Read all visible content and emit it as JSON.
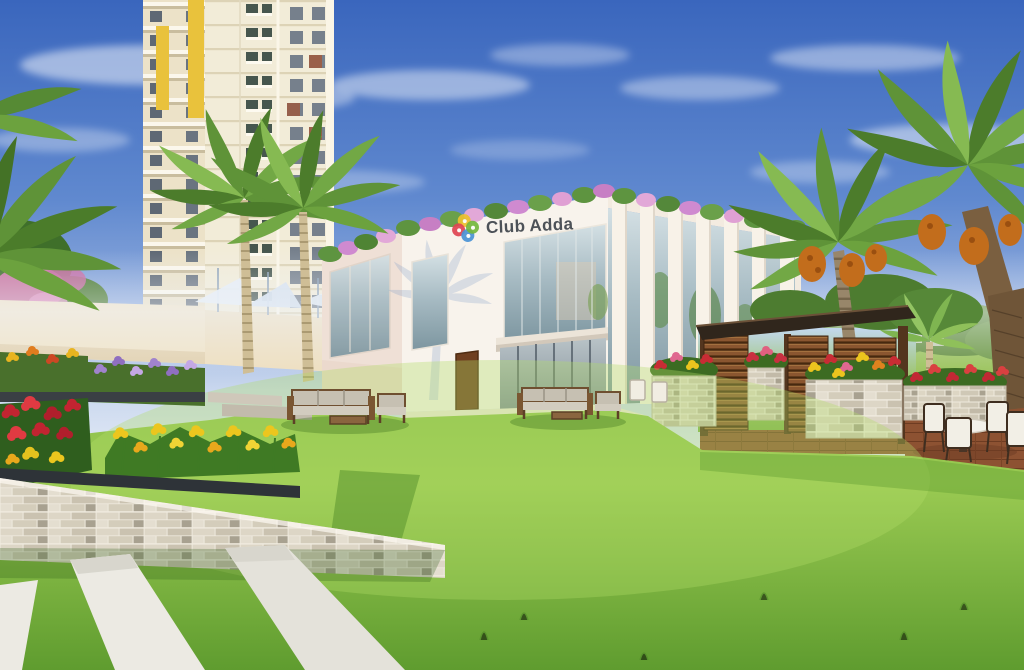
{
  "logo": {
    "word1": "Club",
    "word2": "Adda"
  },
  "palette": {
    "sky_top": "#3a66bd",
    "sky_horizon": "#e8eef7",
    "tower_cream": "#f2ecd8",
    "tower_accent_yellow": "#e9c23c",
    "clubhouse_white": "#f8f3ec",
    "glass_blue": "#a8bcc4",
    "wood_slats": "#8a5630",
    "pergola_roof": "#30261c",
    "stone_planter": "#ddd7c8",
    "lawn_green": "#8fc24c",
    "paving_terracotta": "#8d5232",
    "palm_green": "#5f9338",
    "flower_red": "#c22431",
    "flower_yellow": "#ecc61e",
    "flower_purple": "#a083cc",
    "flower_pink": "#d878ae",
    "logo_text_color": "#4d5258"
  }
}
